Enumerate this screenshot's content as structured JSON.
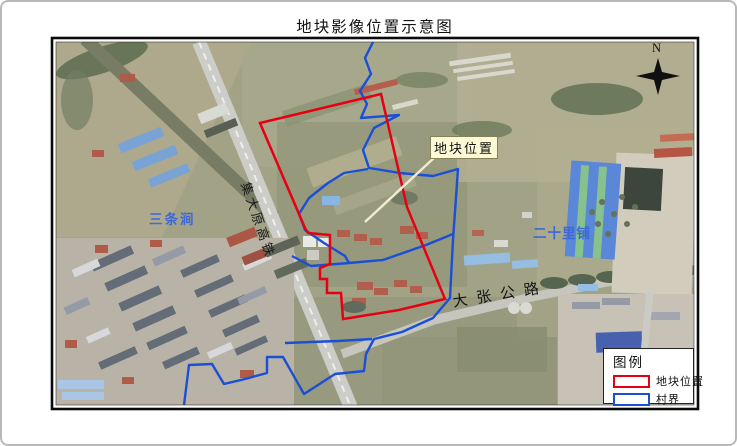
{
  "title": "地块影像位置示意图",
  "map": {
    "labels": {
      "plot_callout": "地块位置",
      "village_santiaojian": "三条涧",
      "village_ershilipu": "二十里铺",
      "road_dazhang": "大张公路",
      "railway_jidayuan": "集大原高铁",
      "north": "N"
    },
    "colors": {
      "plot_outline": "#e60012",
      "village_outline": "#1a4fd6",
      "blue_place_label": "#3e68d8",
      "callout_background": "#fcf9d4"
    }
  },
  "legend": {
    "title": "图例",
    "items": [
      {
        "label": "地块位置",
        "color": "#e60012"
      },
      {
        "label": "村界",
        "color": "#1a4fd6"
      }
    ]
  }
}
